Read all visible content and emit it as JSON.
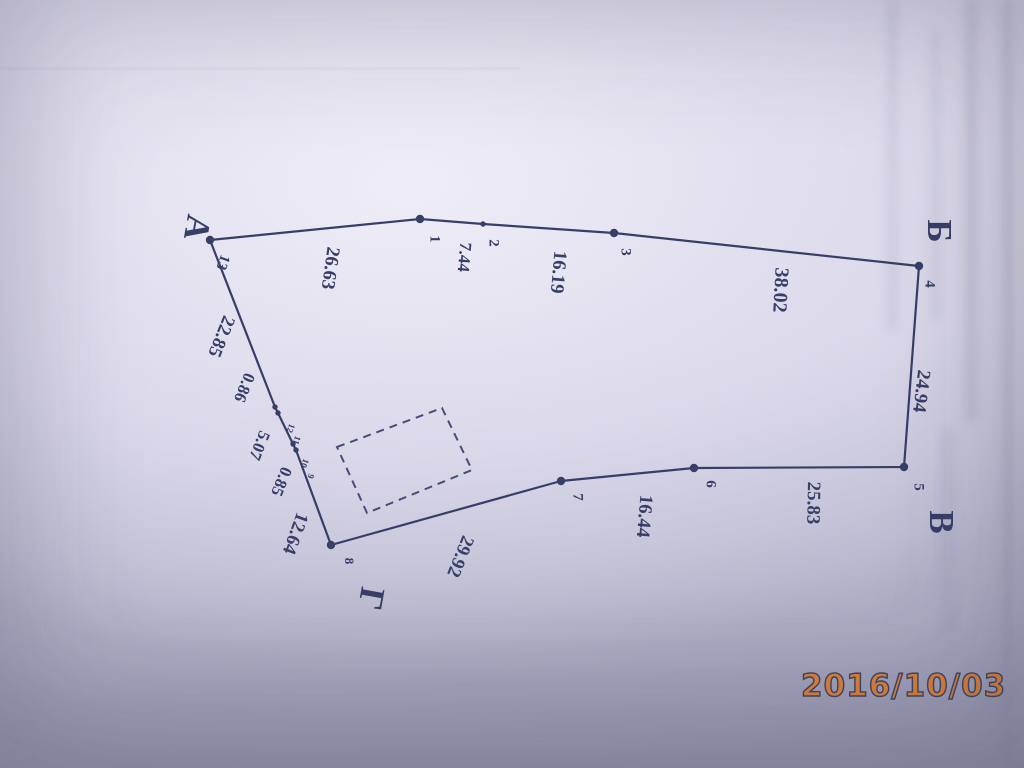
{
  "date_stamp": {
    "text": "2016/10/03",
    "color": "#de8038",
    "outline_color": "#3d4662"
  },
  "survey": {
    "ink_color": "#373f68",
    "corners": [
      {
        "label": "А",
        "x": 194,
        "y": 227,
        "size": 35,
        "rot": 100
      },
      {
        "label": "Б",
        "x": 936,
        "y": 231,
        "size": 35,
        "rot": 90
      },
      {
        "label": "В",
        "x": 938,
        "y": 522,
        "size": 35,
        "rot": 90
      },
      {
        "label": "Г",
        "x": 368,
        "y": 598,
        "size": 35,
        "rot": 100
      }
    ],
    "measurements": [
      {
        "text": "22.85",
        "x": 220,
        "y": 336,
        "rot": 112
      },
      {
        "text": "0.86",
        "x": 243,
        "y": 387,
        "size": 17,
        "rot": 112
      },
      {
        "text": "5.07",
        "x": 258,
        "y": 445,
        "size": 17,
        "rot": 112
      },
      {
        "text": "0.85",
        "x": 280,
        "y": 481,
        "size": 17,
        "rot": 112
      },
      {
        "text": "12.64",
        "x": 294,
        "y": 533,
        "rot": 110
      },
      {
        "text": "26.63",
        "x": 329,
        "y": 268,
        "rot": 98
      },
      {
        "text": "7.44",
        "x": 463,
        "y": 257,
        "size": 17,
        "rot": 95
      },
      {
        "text": "16.19",
        "x": 557,
        "y": 272,
        "rot": 95
      },
      {
        "text": "38.02",
        "x": 779,
        "y": 290,
        "size": 20,
        "rot": 93
      },
      {
        "text": "24.94",
        "x": 920,
        "y": 391,
        "rot": 97
      },
      {
        "text": "25.83",
        "x": 812,
        "y": 503,
        "rot": 91
      },
      {
        "text": "16.44",
        "x": 643,
        "y": 516,
        "rot": 95
      },
      {
        "text": "29.92",
        "x": 459,
        "y": 556,
        "rot": 112
      }
    ],
    "point_numbers": [
      {
        "text": "13",
        "x": 222,
        "y": 262,
        "rot": 110
      },
      {
        "text": "1",
        "x": 434,
        "y": 239
      },
      {
        "text": "2",
        "x": 493,
        "y": 243
      },
      {
        "text": "3",
        "x": 625,
        "y": 252
      },
      {
        "text": "4",
        "x": 929,
        "y": 284
      },
      {
        "text": "5",
        "x": 918,
        "y": 487
      },
      {
        "text": "6",
        "x": 710,
        "y": 484
      },
      {
        "text": "7",
        "x": 577,
        "y": 497
      },
      {
        "text": "8",
        "x": 348,
        "y": 561,
        "size": 13
      },
      {
        "text": "12",
        "x": 290,
        "y": 428,
        "size": 9,
        "rot": 110
      },
      {
        "text": "11",
        "x": 296,
        "y": 440,
        "size": 9,
        "rot": 110
      },
      {
        "text": "10",
        "x": 304,
        "y": 463,
        "size": 9,
        "rot": 110
      },
      {
        "text": "9",
        "x": 310,
        "y": 476,
        "size": 9,
        "rot": 110
      }
    ],
    "boundary": [
      [
        210,
        240
      ],
      [
        420,
        219
      ],
      [
        483,
        224
      ],
      [
        614,
        233
      ],
      [
        919,
        266
      ],
      [
        904,
        467
      ],
      [
        694,
        468
      ],
      [
        561,
        481
      ],
      [
        331,
        545
      ],
      [
        296,
        450
      ],
      [
        293,
        444
      ],
      [
        278,
        413
      ],
      [
        275,
        407
      ],
      [
        210,
        240
      ]
    ],
    "main_dots": [
      [
        210,
        240
      ],
      [
        420,
        219
      ],
      [
        614,
        233
      ],
      [
        919,
        266
      ],
      [
        904,
        467
      ],
      [
        694,
        468
      ],
      [
        561,
        481
      ],
      [
        331,
        545
      ]
    ],
    "small_dots": [
      [
        483,
        224
      ],
      [
        275,
        407
      ],
      [
        278,
        413
      ],
      [
        293,
        444
      ],
      [
        296,
        450
      ]
    ],
    "building_outline": [
      [
        337,
        447
      ],
      [
        442,
        408
      ],
      [
        472,
        470
      ],
      [
        367,
        513
      ]
    ]
  }
}
